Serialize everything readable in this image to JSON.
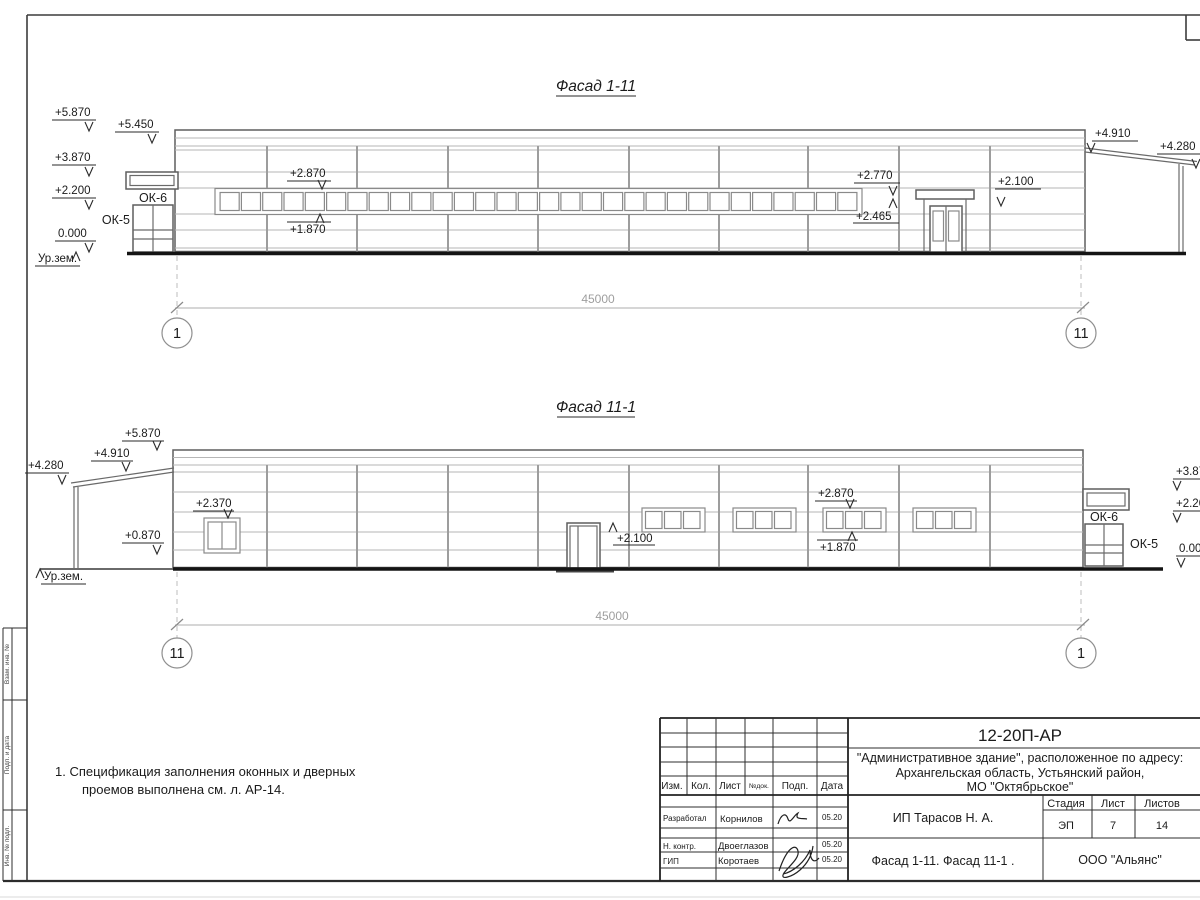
{
  "frame": {
    "side_box_top": "Взам. инв. №",
    "side_box_mid": "Подп. и дата",
    "side_box_bottom": "Инв. № подл."
  },
  "notes": {
    "line1": "1. Спецификация заполнения оконных и дверных",
    "line2": "проемов выполнена см. л. АР-14."
  },
  "facade1": {
    "title": "Фасад 1-11",
    "elev_5870": "+5.870",
    "elev_5450": "+5.450",
    "elev_3870": "+3.870",
    "elev_2200": "+2.200",
    "elev_0": "0.000",
    "ground_label": "Ур.зем.",
    "ok6": "ОК-6",
    "ok5": "ОК-5",
    "ribbon_top": "+2.870",
    "ribbon_bottom": "+1.870",
    "door2_top": "+2.770",
    "door2_canopy": "+2.465",
    "wall_right": "+2.100",
    "annex_high": "+4.910",
    "annex_low": "+4.280",
    "dim_total": "45000",
    "axis_left": "1",
    "axis_right": "11"
  },
  "facade2": {
    "title": "Фасад 11-1",
    "elev_5870": "+5.870",
    "elev_4910": "+4.910",
    "elev_4280": "+4.280",
    "win_left_top": "+2.370",
    "elev_0870": "+0.870",
    "ground_label": "Ур.зем.",
    "door_top": "+2.100",
    "ribbon_top": "+2.870",
    "ribbon_bottom": "+1.870",
    "ok6": "ОК-6",
    "ok5": "ОК-5",
    "right_3870": "+3.870",
    "right_2200": "+2.200",
    "right_0": "0.000",
    "dim_total": "45000",
    "axis_left": "11",
    "axis_right": "1"
  },
  "titleblock": {
    "doc_number": "12-20П-АР",
    "address_line1": "\"Административное здание\", расположенное по адресу:",
    "address_line2": "Архангельская область, Устьянский район,",
    "address_line3": "МО \"Октябрьское\"",
    "col_izm": "Изм.",
    "col_kol": "Кол.",
    "col_list": "Лист",
    "col_ndok": "№док.",
    "col_podp": "Подп.",
    "col_data": "Дата",
    "staff": [
      {
        "role": "Разработал",
        "name": "Корнилов",
        "date": "05.20"
      },
      {
        "role": "Н. контр.",
        "name": "Двоеглазов",
        "date": "05.20"
      },
      {
        "role": "ГИП",
        "name": "Коротаев",
        "date": "05.20"
      }
    ],
    "client": "ИП Тарасов Н. А.",
    "sheet_title": "Фасад 1-11. Фасад 11-1 .",
    "stage_label": "Стадия",
    "sheet_label": "Лист",
    "sheets_label": "Листов",
    "stage": "ЭП",
    "sheet_no": "7",
    "sheets_total": "14",
    "company": "ООО \"Альянс\""
  },
  "drawing": {
    "dim_total_mm": 45000,
    "ribbon_panes": 30,
    "window_group_count": 4,
    "panes_per_group": 3
  }
}
